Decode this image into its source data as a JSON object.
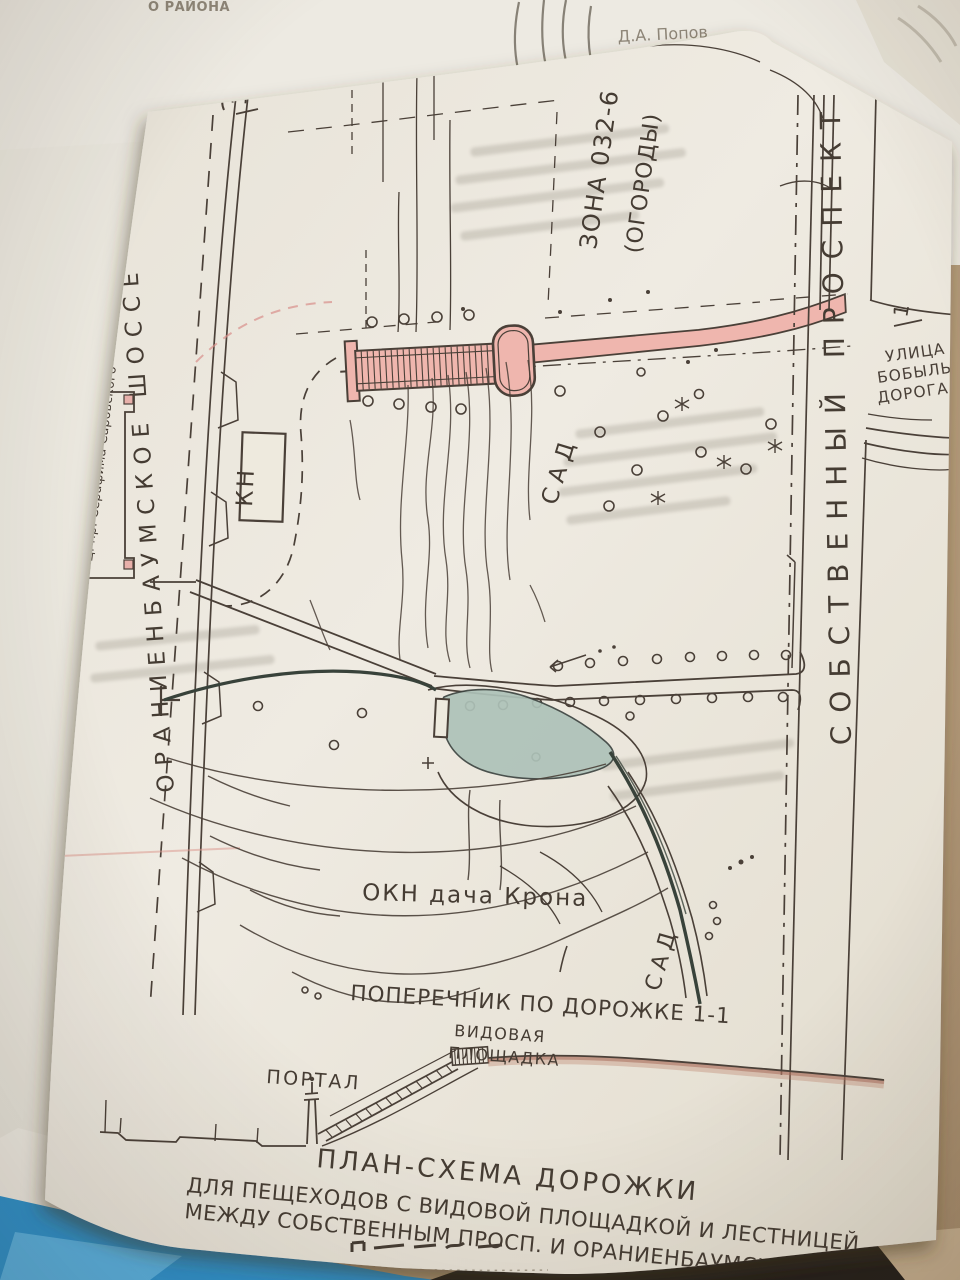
{
  "doc": {
    "corner_label": "О РАЙОНА",
    "author": "Д.А. Попов"
  },
  "map": {
    "road_left": "ОРАНИЕНБАУМСКОЕ ШОССЕ",
    "road_right": "СОБСТВЕННЫЙ ПРОСПЕКТ",
    "church": "Ц. пр. Серафима Саровского",
    "zone_label": "ЗОНА 032-6",
    "zone_sub": "(ОГОРОДЫ)",
    "kn_box": "КН",
    "garden_center": "САД",
    "garden_bottom": "САД",
    "street_line1": "УЛИЦА",
    "street_line2": "БОБЫЛЬС",
    "street_line3": "ДОРОГА",
    "heritage_label": "ОКН дача Крона",
    "section_marker_top": "1",
    "section_marker_right": "1",
    "crosssection_caption": "ПОПЕРЕЧНИК ПО ДОРОЖКЕ 1-1"
  },
  "section": {
    "portal": "ПОРТАЛ",
    "platform_line1": "ВИДОВАЯ",
    "platform_line2": "ПЛОЩАДКА"
  },
  "title": {
    "line1": "ПЛАН-СХЕМА ДОРОЖКИ",
    "line2": "ДЛЯ ПЕЩЕХОДОВ С ВИДОВОЙ ПЛОЩАДКОЙ И ЛЕСТНИЦЕЙ",
    "line3": "МЕЖДУ СОБСТВЕННЫМ ПРОСП. И ОРАНИЕНБАУМСКИМ ШОССЕ"
  },
  "colors": {
    "paper": "#ece8df",
    "under_paper": "#edeae2",
    "ink": "#4a4038",
    "pink_highlight": "#efb6ae",
    "pond": "#adc2b8",
    "blue_folder": "#2e93cf",
    "table": "#bca385",
    "dark_object": "#241f1a"
  }
}
